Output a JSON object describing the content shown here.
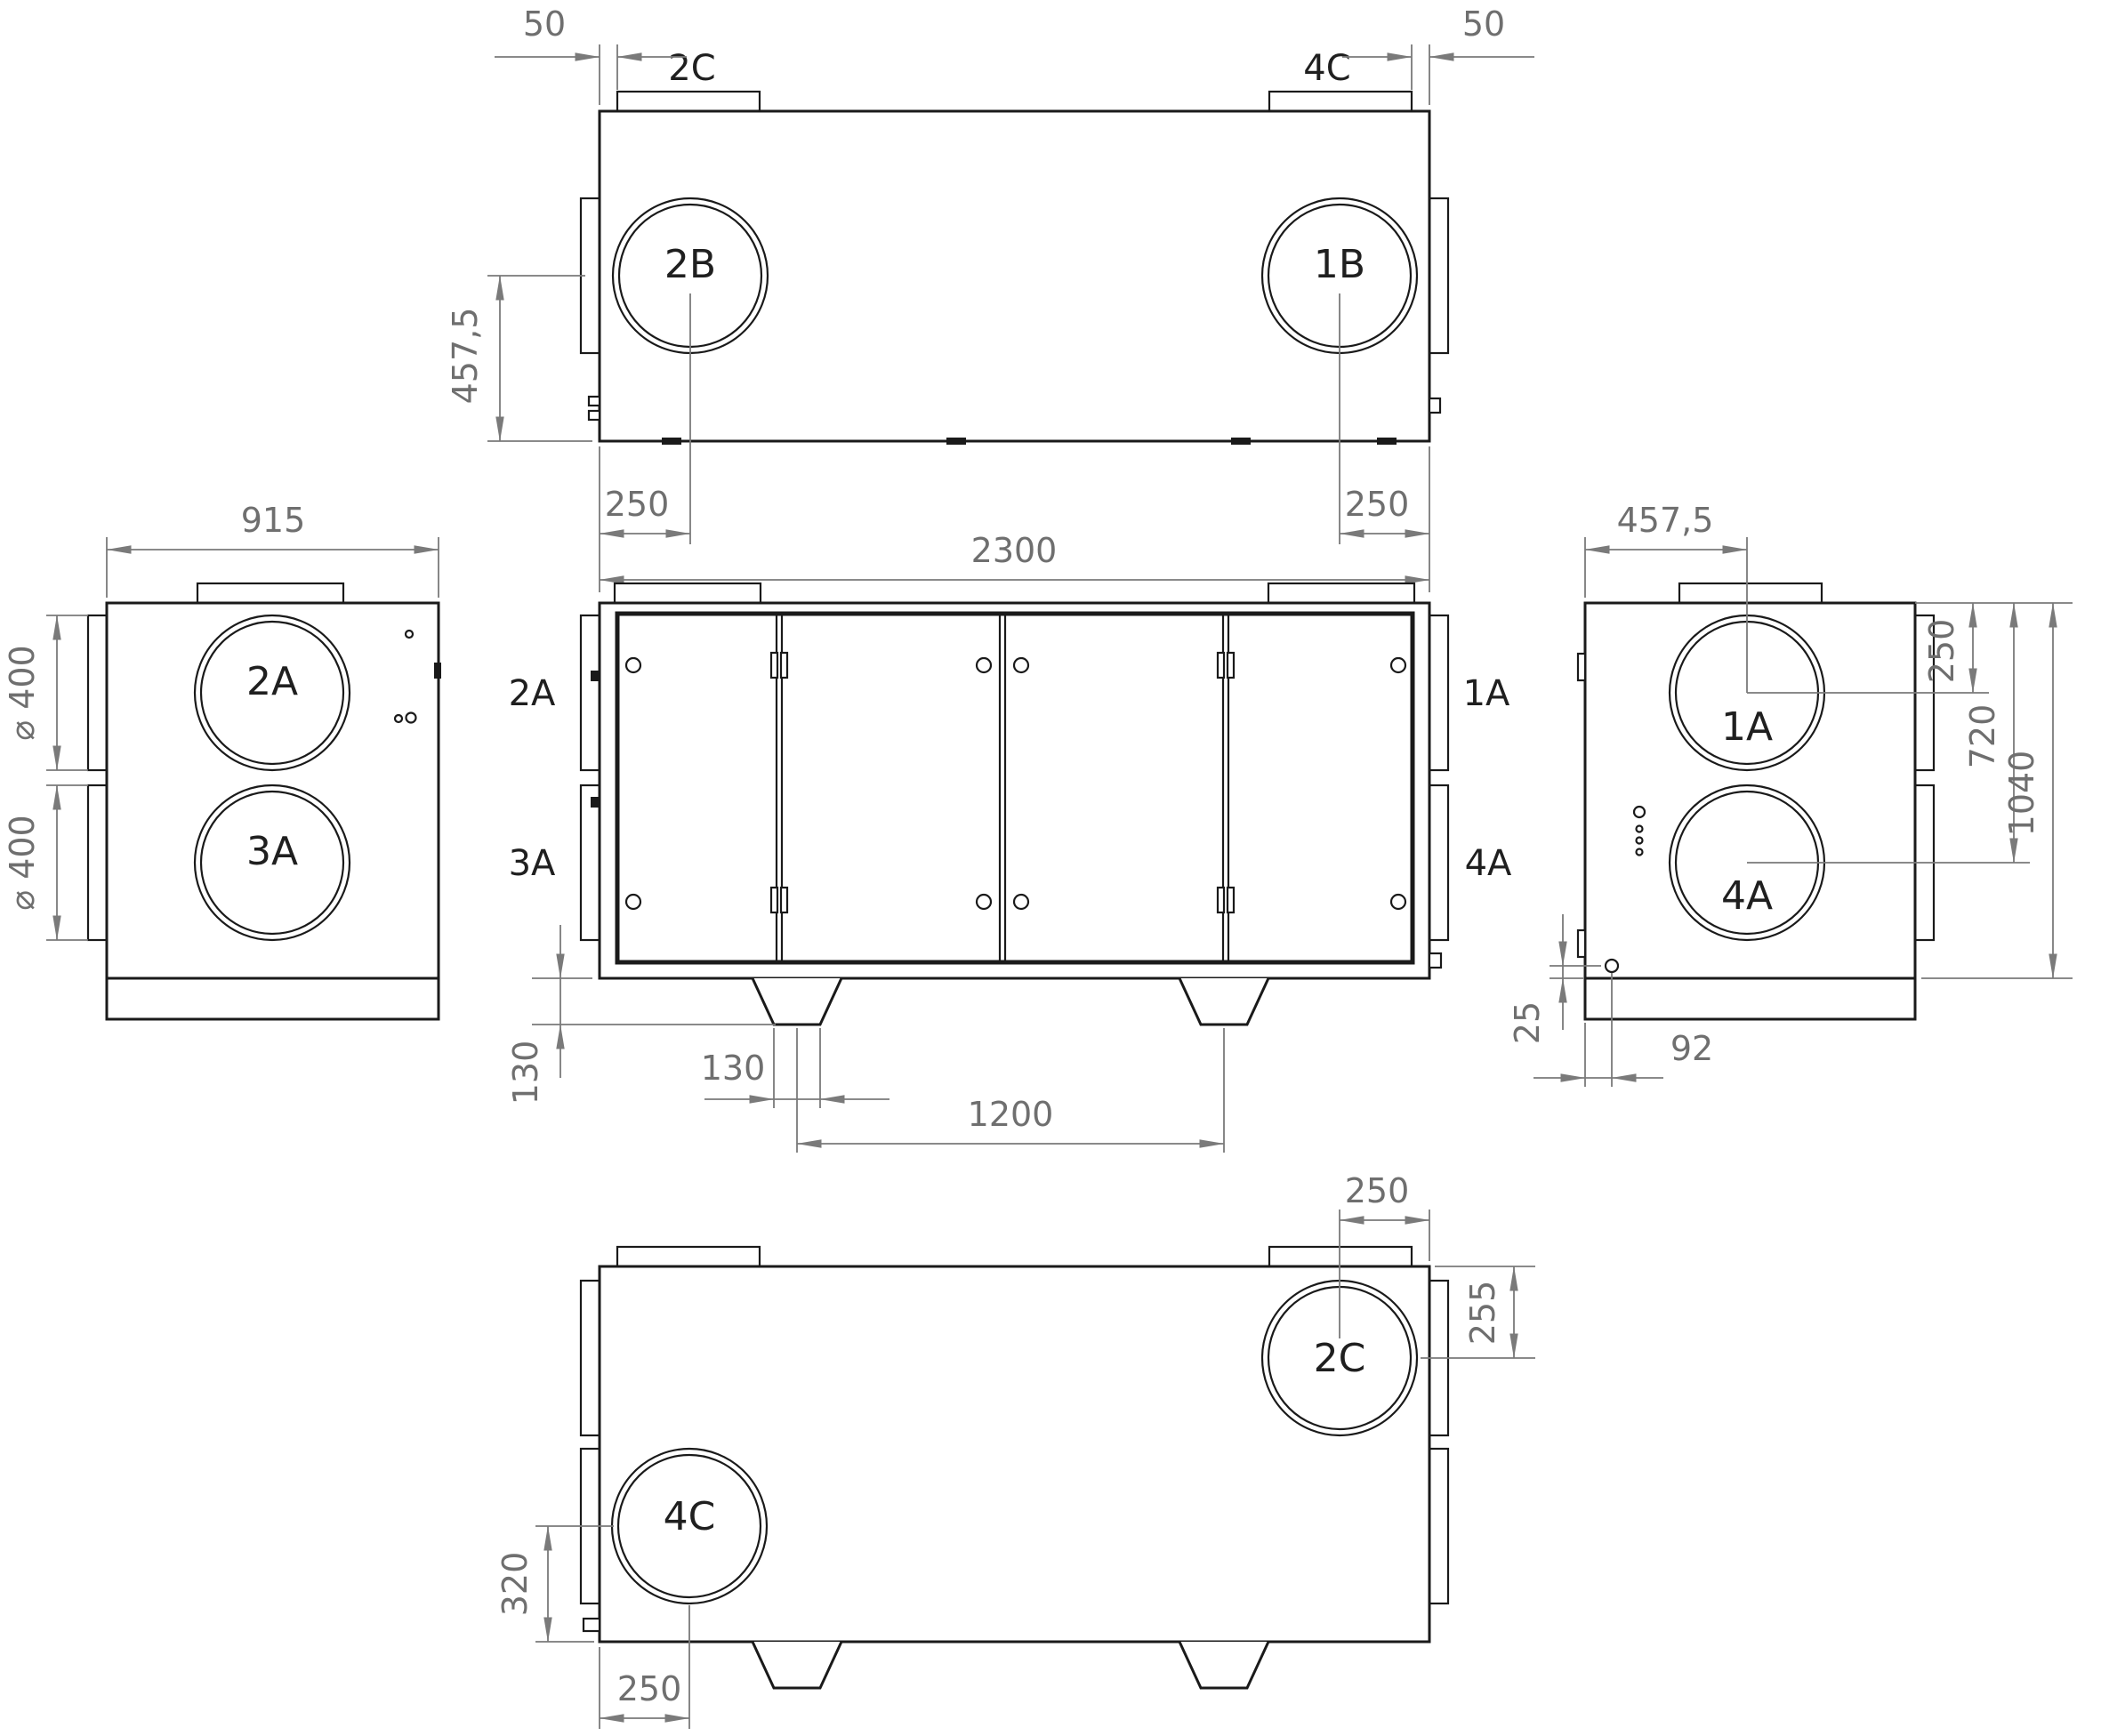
{
  "drawing_type": "orthographic multi-view technical drawing of ventilation unit",
  "colors": {
    "geometry_line": "#1a1a1a",
    "dimension_line": "#7a7a7a",
    "background": "#ffffff"
  },
  "views": {
    "top": {
      "name": "top view",
      "stub_left": "2C",
      "stub_right": "4C",
      "port_left": "2B",
      "port_right": "1B",
      "dim_gap_left": "50",
      "dim_gap_right": "50",
      "dim_depth_to_center": "457,5",
      "dim_center_left": "250",
      "dim_center_right": "250"
    },
    "front": {
      "name": "front view",
      "label_upper_left": "2A",
      "label_lower_left": "3A",
      "label_upper_right": "1A",
      "label_lower_right": "4A",
      "dim_length": "2300",
      "dim_foot_height": "130",
      "dim_foot_width": "130",
      "dim_foot_pitch": "1200"
    },
    "left": {
      "name": "left side view",
      "dim_depth": "915",
      "port_upper": "2A",
      "port_lower": "3A",
      "dim_dia_upper": "⌀ 400",
      "dim_dia_lower": "⌀ 400"
    },
    "right": {
      "name": "right side view",
      "dim_center_offset": "457,5",
      "port_upper": "1A",
      "port_lower": "4A",
      "dim_top_to_upper": "250",
      "dim_top_to_lower": "720",
      "dim_height": "1040",
      "dim_hole_up": "25",
      "dim_hole_in": "92"
    },
    "rear": {
      "name": "rear (bottom-connection) view",
      "port_upper_right": "2C",
      "port_lower_left": "4C",
      "dim_upper_to_edge": "250",
      "dim_top_to_upper": "255",
      "dim_lower_to_bottom": "320",
      "dim_lower_to_edge": "250"
    }
  }
}
